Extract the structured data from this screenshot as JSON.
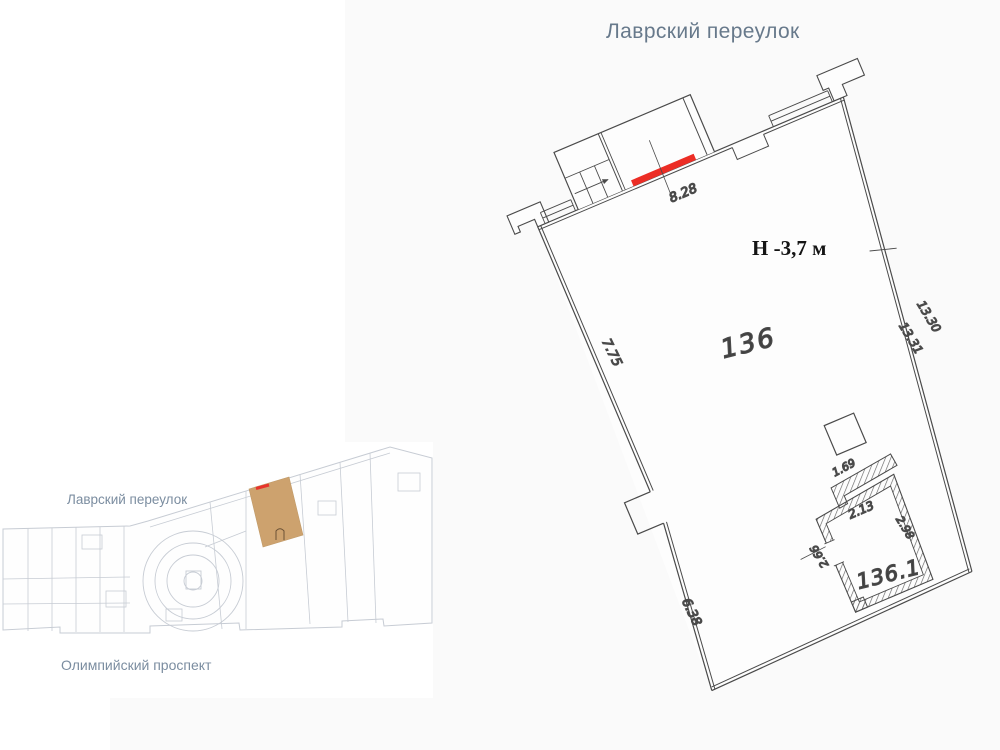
{
  "title": "Лаврский переулок",
  "main_plan": {
    "height_note": "Н -3,7 м",
    "unit_label": "136",
    "room_label": "136.1",
    "dimensions": {
      "top_entrance": "8.28",
      "left_upper": "7.75",
      "left_lower": "6.38",
      "right_outer": "13.30",
      "right_inner": "13.31",
      "room_top_outer": "1.69",
      "room_top_inner": "2.13",
      "room_right": "2.98",
      "room_left": "2.66"
    },
    "colors": {
      "wall_line": "#4a4a4a",
      "entrance_red": "#ec2d25",
      "unit_label_pink": "#b6a7a7",
      "room_label_pink": "#c2808c"
    }
  },
  "minimap": {
    "street_top": "Лаврский переулок",
    "street_bottom": "Олимпийский проспект",
    "highlight_color": "#cda26e",
    "highlight_mark_color": "#e8342c",
    "line_color": "#c7ccd4"
  }
}
